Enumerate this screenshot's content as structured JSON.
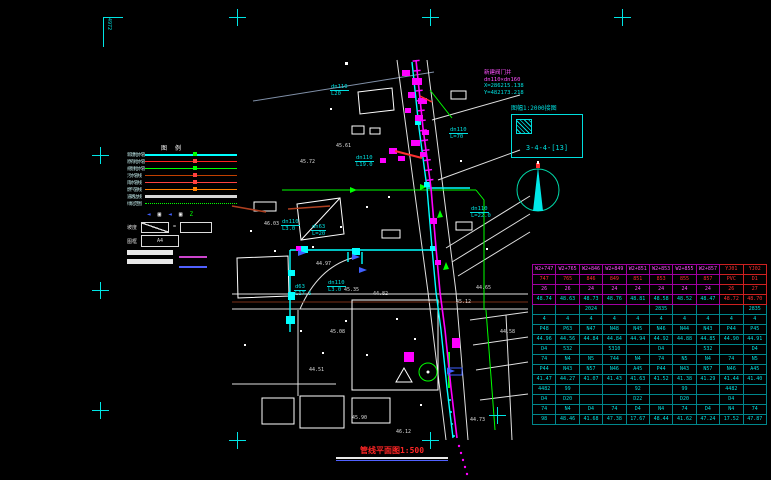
{
  "colors": {
    "cyan": "#00ffff",
    "magenta": "#ff00ff",
    "red": "#ff2525",
    "green": "#00ff00",
    "white": "#ffffff",
    "blue": "#4060ff",
    "brown": "#b04020",
    "orange": "#ff8000"
  },
  "corner_mark": {
    "text": "4972"
  },
  "coord_note": {
    "line1": "新建阀门井",
    "line2": "dn110×dn160",
    "line3": "X=286215.138",
    "line4": "Y=482173.218"
  },
  "index_box": {
    "caption": "图幅1:2000接图",
    "label": "3-4-4-[13]"
  },
  "title_block": {
    "drawing_title": "管线平面图1:500"
  },
  "legend": {
    "header": "图例",
    "items": [
      {
        "label": "新建给水管",
        "color": "#00ffff",
        "thick": 2,
        "style": "solid",
        "marker": "#00ff00"
      },
      {
        "label": "原有给水管",
        "color": "#ff2020",
        "thick": 1,
        "style": "solid",
        "marker": "#ff4040"
      },
      {
        "label": "规划给水管",
        "color": "#00ff00",
        "thick": 1,
        "style": "solid",
        "marker": "#00ff00"
      },
      {
        "label": "污水管线",
        "color": "#c04000",
        "thick": 1,
        "style": "solid",
        "marker": "#ff4040"
      },
      {
        "label": "雨水管线",
        "color": "#ff4040",
        "thick": 1,
        "style": "solid",
        "marker": "#ff4040"
      },
      {
        "label": "燃气管线",
        "color": "#ff8000",
        "thick": 1,
        "style": "solid",
        "marker": "#ff8000"
      },
      {
        "label": "道路边线",
        "color": "#d8d8d8",
        "thick": 3,
        "style": "solid",
        "marker": ""
      },
      {
        "label": "绿化范围",
        "color": "#00ff00",
        "thick": 1,
        "style": "dotted",
        "marker": ""
      }
    ],
    "symbols": [
      {
        "glyph": "◄",
        "color": "#4060ff"
      },
      {
        "glyph": "▣",
        "color": "#ffffff"
      },
      {
        "glyph": "◄",
        "color": "#4060ff"
      },
      {
        "glyph": "▣",
        "color": "#ffffff"
      },
      {
        "glyph": "Z",
        "color": "#00ff00"
      }
    ],
    "scale_label": "坡度",
    "equals": "=",
    "frame_label": "图框",
    "frame_text": "A4"
  },
  "annotations": [
    {
      "x": 330,
      "y": 84,
      "l1": "dn110",
      "l2": "L20"
    },
    {
      "x": 355,
      "y": 155,
      "l1": "dn110",
      "l2": "L19.0"
    },
    {
      "x": 449,
      "y": 127,
      "l1": "dn110",
      "l2": "L=70"
    },
    {
      "x": 470,
      "y": 206,
      "l1": "dn110",
      "l2": "L=22.0"
    },
    {
      "x": 281,
      "y": 219,
      "l1": "dn110",
      "l2": "L3.0"
    },
    {
      "x": 311,
      "y": 224,
      "l1": "dn63",
      "l2": "L=20"
    },
    {
      "x": 327,
      "y": 280,
      "l1": "dn110",
      "l2": "L3.0"
    },
    {
      "x": 294,
      "y": 284,
      "l1": "d63",
      "l2": "L17.5"
    }
  ],
  "elev_labels": [
    {
      "x": 336,
      "y": 143,
      "t": "45.61"
    },
    {
      "x": 300,
      "y": 159,
      "t": "45.72"
    },
    {
      "x": 264,
      "y": 221,
      "t": "46.03"
    },
    {
      "x": 316,
      "y": 261,
      "t": "44.97"
    },
    {
      "x": 344,
      "y": 287,
      "t": "45.35"
    },
    {
      "x": 373,
      "y": 291,
      "t": "44.82"
    },
    {
      "x": 456,
      "y": 299,
      "t": "45.12"
    },
    {
      "x": 476,
      "y": 285,
      "t": "44.65"
    },
    {
      "x": 330,
      "y": 329,
      "t": "45.08"
    },
    {
      "x": 309,
      "y": 367,
      "t": "44.51"
    },
    {
      "x": 352,
      "y": 415,
      "t": "45.90"
    },
    {
      "x": 396,
      "y": 429,
      "t": "46.12"
    },
    {
      "x": 470,
      "y": 417,
      "t": "44.73"
    },
    {
      "x": 500,
      "y": 329,
      "t": "44.58"
    }
  ],
  "crosshairs": [
    {
      "x": 237,
      "y": 17
    },
    {
      "x": 430,
      "y": 17
    },
    {
      "x": 622,
      "y": 17
    },
    {
      "x": 100,
      "y": 155
    },
    {
      "x": 100,
      "y": 290
    },
    {
      "x": 100,
      "y": 410
    },
    {
      "x": 237,
      "y": 440
    },
    {
      "x": 430,
      "y": 440
    },
    {
      "x": 497,
      "y": 415
    }
  ],
  "table": {
    "red_cols": [
      8,
      9
    ],
    "rows": [
      {
        "color": "#ff50ff",
        "hd": true,
        "cells": [
          "W2+747",
          "W2+765",
          "W2+846",
          "W2+849",
          "W2+851",
          "W2+853",
          "W2+855",
          "W2+857",
          "YJ01",
          "YJ02"
        ]
      },
      {
        "color": "#ff3030",
        "hd": true,
        "cells": [
          "747",
          "765",
          "846",
          "849",
          "851",
          "853",
          "855",
          "857",
          "PVC",
          "D1"
        ]
      },
      {
        "color": "#ff50ff",
        "hd": true,
        "cells": [
          "26",
          "26",
          "24",
          "24",
          "24",
          "24",
          "24",
          "24",
          "26",
          "27"
        ]
      },
      {
        "color": "#00e0e0",
        "hd": true,
        "cells": [
          "48.74",
          "48.63",
          "48.73",
          "48.76",
          "48.81",
          "48.58",
          "48.52",
          "48.47",
          "48.72",
          "48.70"
        ]
      },
      {
        "color": "#00e0e0",
        "cells": [
          "",
          "",
          "2024",
          "",
          "",
          "2835",
          "",
          "",
          "",
          "2835"
        ]
      },
      {
        "color": "#00e0e0",
        "cells": [
          "4",
          "4",
          "4",
          "4",
          "4",
          "4",
          "4",
          "4",
          "4",
          "4"
        ]
      },
      {
        "color": "#00e0e0",
        "cells": [
          "P48",
          "P63",
          "N47",
          "N48",
          "N45",
          "N46",
          "N44",
          "N43",
          "P44",
          "P45"
        ]
      },
      {
        "color": "#00e0e0",
        "cells": [
          "44.96",
          "44.56",
          "44.84",
          "44.84",
          "44.94",
          "44.92",
          "44.88",
          "44.85",
          "44.90",
          "44.91"
        ]
      },
      {
        "color": "#00e0e0",
        "cells": [
          "D4",
          "532",
          "",
          "5310",
          "",
          "D4",
          "",
          "532",
          "",
          "D4"
        ]
      },
      {
        "color": "#00e0e0",
        "cells": [
          "74",
          "N4",
          "N5",
          "744",
          "N4",
          "74",
          "N5",
          "N4",
          "74",
          "N5"
        ]
      },
      {
        "color": "#00e0e0",
        "cells": [
          "P44",
          "N43",
          "N57",
          "N46",
          "A45",
          "P44",
          "N43",
          "N57",
          "N46",
          "A45"
        ]
      },
      {
        "color": "#00e0e0",
        "cells": [
          "41.47",
          "44.27",
          "41.07",
          "41.43",
          "41.63",
          "41.52",
          "41.38",
          "41.29",
          "41.44",
          "41.40"
        ]
      },
      {
        "color": "#00e0e0",
        "cells": [
          "4482",
          "99",
          "",
          "",
          "92",
          "",
          "99",
          "",
          "4482",
          ""
        ]
      },
      {
        "color": "#00e0e0",
        "cells": [
          "D4",
          "D20",
          "",
          "",
          "D22",
          "",
          "D20",
          "",
          "D4",
          ""
        ]
      },
      {
        "color": "#00e0e0",
        "cells": [
          "74",
          "N4",
          "D4",
          "74",
          "D4",
          "N4",
          "74",
          "D4",
          "N4",
          "74"
        ]
      },
      {
        "color": "#00e0e0",
        "cells": [
          "98",
          "48.46",
          "41.68",
          "47.38",
          "17.67",
          "48.44",
          "41.62",
          "47.24",
          "17.52",
          "47.87"
        ]
      }
    ]
  }
}
